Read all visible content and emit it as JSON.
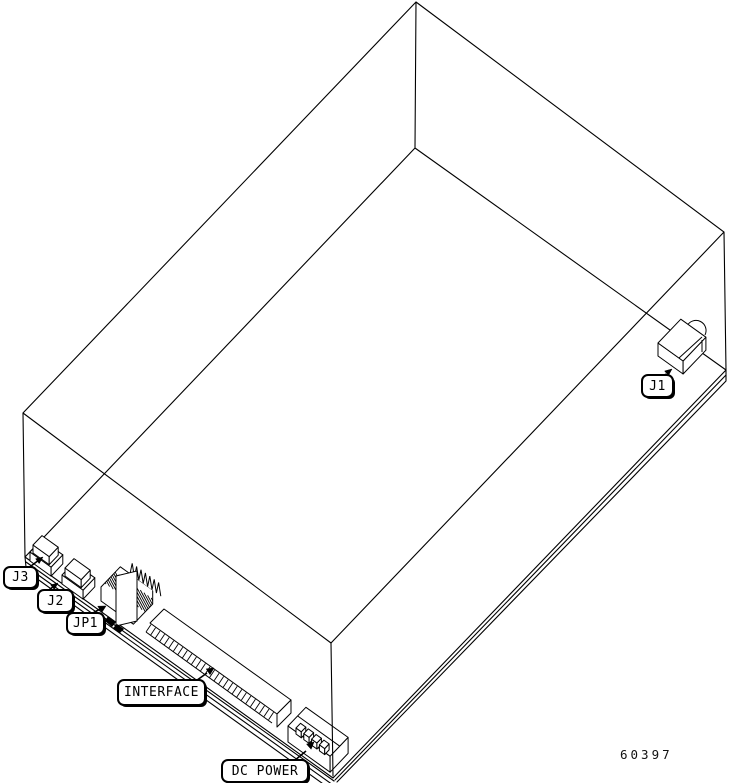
{
  "figure": {
    "figure_number": "60397",
    "callouts": {
      "j3": "J3",
      "j2": "J2",
      "jp1": "JP1",
      "interface": "INTERFACE",
      "dc_power": "DC POWER",
      "j1": "J1"
    },
    "colors": {
      "line": "#000000",
      "background": "#ffffff"
    }
  }
}
